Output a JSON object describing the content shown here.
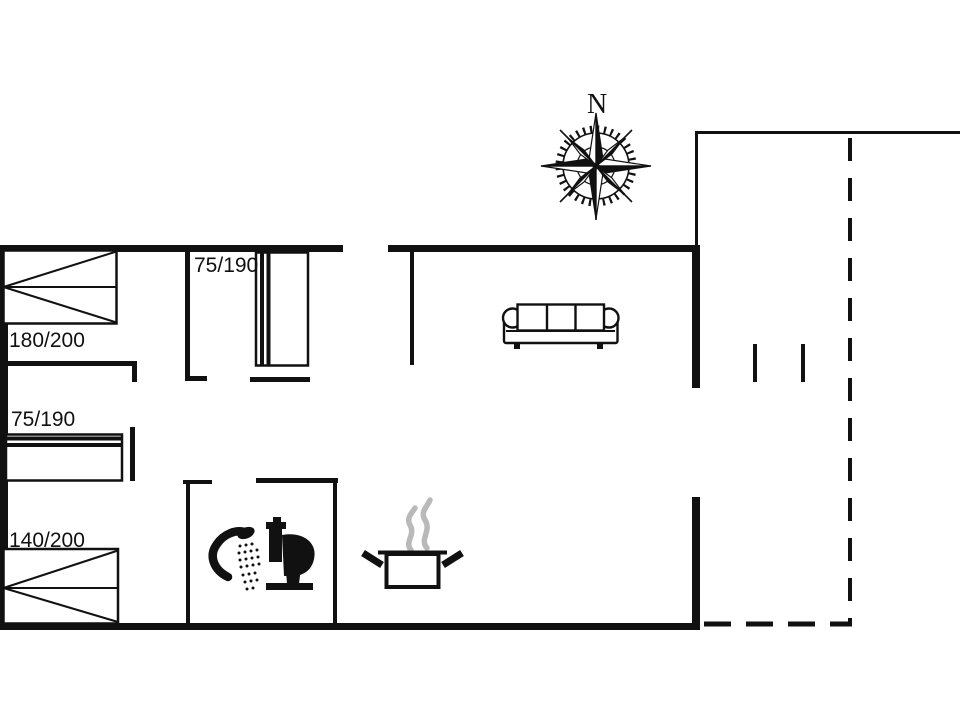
{
  "colors": {
    "background": "#ffffff",
    "line": "#111111",
    "steam": "#b9b9b9"
  },
  "compass": {
    "north_label": "N"
  },
  "beds": [
    {
      "room": "bedroom-top-left",
      "type": "double-bed",
      "label": "180/200"
    },
    {
      "room": "bedroom-top-middle",
      "type": "single-bed",
      "label": "75/190"
    },
    {
      "room": "sleeping-alcove",
      "type": "single-bed",
      "label": "75/190"
    },
    {
      "room": "bedroom-bottom-left",
      "type": "double-bed",
      "label": "140/200"
    }
  ],
  "fixtures": {
    "living_room": [
      "sofa"
    ],
    "bathroom": [
      "shower",
      "toilet"
    ],
    "kitchen": [
      "cooking-pot"
    ],
    "outdoor": [
      "terrace-dashed-outline"
    ]
  }
}
